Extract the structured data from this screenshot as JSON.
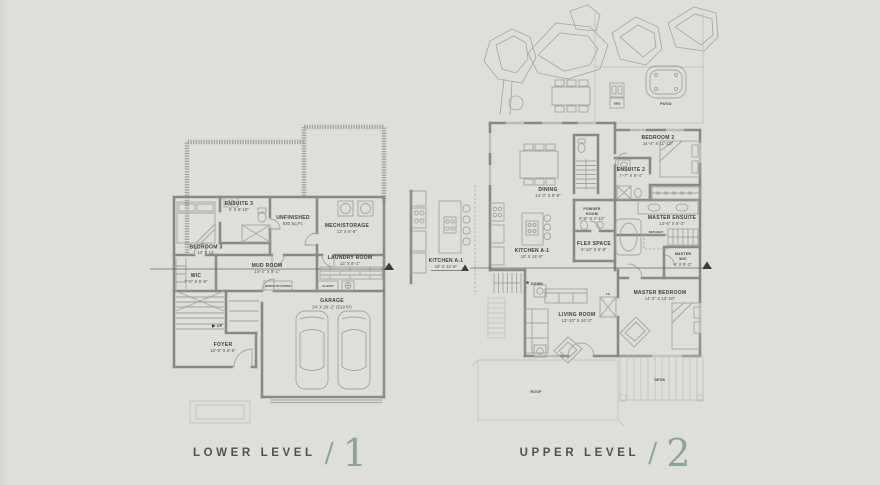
{
  "colors": {
    "background": "#dfdfd9",
    "wall_gray": "#8a8a85",
    "light_line": "#a3a39e",
    "label_ink": "#3c3c39",
    "accent_sage": "#8ba39d",
    "caption_ink": "#4f5356"
  },
  "captions": {
    "lower": {
      "label": "LOWER LEVEL",
      "separator": "/",
      "number": "1"
    },
    "upper": {
      "label": "UPPER LEVEL",
      "separator": "/",
      "number": "2"
    }
  },
  "lower_level": {
    "ensuite3": {
      "name": "ENSUITE 3",
      "dims": "5' X 8'-10\""
    },
    "bedroom3": {
      "name": "BEDROOM 3",
      "dims": "12' X 12'"
    },
    "wic": {
      "name": "WIC",
      "dims": "7'-5\" X 5'-8\""
    },
    "unfinished": {
      "name": "UNFINISHED",
      "dims": "530 Sq.Ft."
    },
    "mech_storage": {
      "name": "MECH/STORAGE",
      "dims": "12' X 6'-8\""
    },
    "laundry": {
      "name": "LAUNDRY ROOM",
      "dims": "12' X 8'-1\""
    },
    "mud_room": {
      "name": "MUD ROOM",
      "dims": "14'-4\" X 8'-1\""
    },
    "foyer": {
      "name": "FOYER",
      "dims": "10'-9\" X 6'-9\""
    },
    "garage": {
      "name": "GARAGE",
      "dims": "24' X 20'-2\" (519 ft²)"
    },
    "up": "UP",
    "bench": "BENCH W/ HOOKS",
    "closet": "CLOSET"
  },
  "kitchen_detail": {
    "name": "KITCHEN A-1",
    "dims": "10' X 14'-8\""
  },
  "upper_level": {
    "dining": {
      "name": "DINING",
      "dims": "14'-3\" X 8'-8\""
    },
    "kitchen": {
      "name": "KITCHEN A-1",
      "dims": "10' X 14'-8\""
    },
    "bedroom2": {
      "name": "BEDROOM 2",
      "dims": "14'-4\" X 11'-10\""
    },
    "ensuite2": {
      "name": "ENSUITE 2",
      "dims": "7'-7\" X 8'-4\""
    },
    "powder": {
      "line1": "POWDER",
      "line2": "ROOM",
      "dims": "6'-9\" X 4'-10\""
    },
    "flex": {
      "name": "FLEX SPACE",
      "dims": "6'-10\" X 5'-8\""
    },
    "master_ensuite": {
      "name": "MASTER ENSUITE",
      "dims": "13'-6\" X 5'-3\""
    },
    "master_wic": {
      "line1": "MASTER",
      "line2": "WIC",
      "dims": "6' X 9'-3\""
    },
    "master_bedroom": {
      "name": "MASTER BEDROOM",
      "dims": "14'-2\" X 13'-10\""
    },
    "living": {
      "name": "LIVING ROOM",
      "dims": "13'-10\" X 16'-2\""
    },
    "deck": "DECK",
    "roof": "ROOF",
    "patio": "PATIO",
    "bbq": "BBQ",
    "skylight": "SKYLIGHT",
    "fp": "FP",
    "down": "DOWN"
  }
}
